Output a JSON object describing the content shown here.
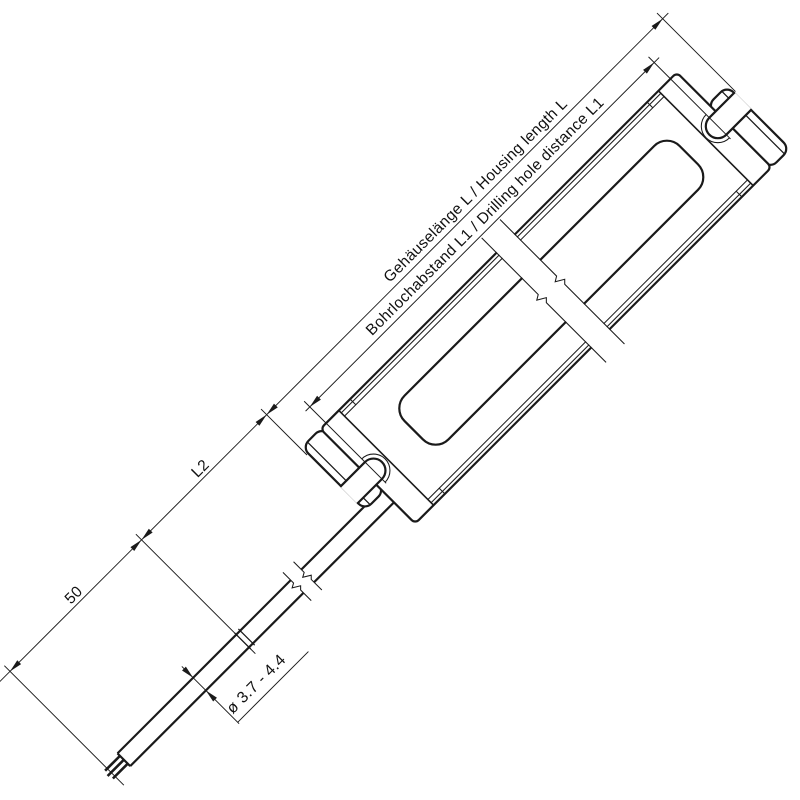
{
  "drawing": {
    "type": "technical dimensional drawing of linear LED driver housing, top view rotated 45 degrees",
    "dimensions": {
      "housing_length_label": "Gehäuselänge L / Housing length L",
      "hole_distance_label": "Bohrlochabstand L1 / Drilling hole distance L1",
      "cable_section_label": "L2",
      "lead_length_label": "50",
      "cable_diameter_label": "ø 3.7 - 4.4"
    }
  },
  "colors": {
    "line": "#1a1a1a",
    "background": "#ffffff"
  }
}
